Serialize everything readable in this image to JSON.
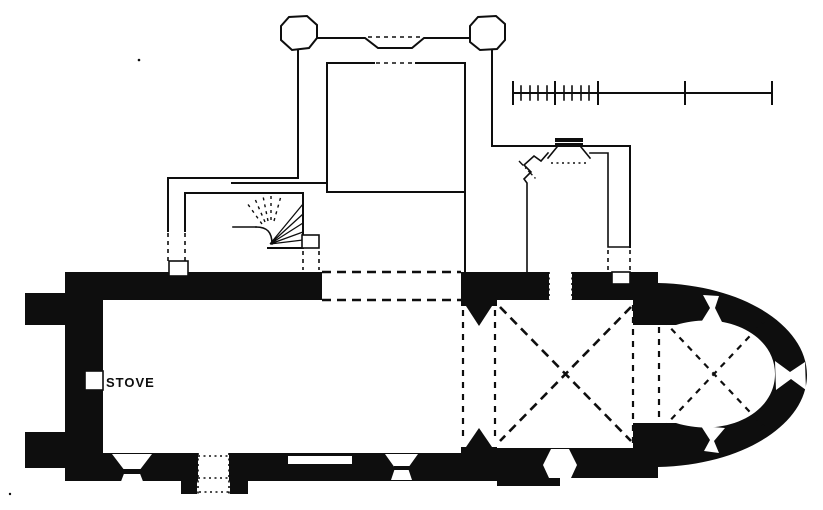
{
  "plan": {
    "labels": {
      "stove": "STOVE"
    },
    "colors": {
      "ink": "#0e0e0e",
      "paper": "#ffffff"
    }
  }
}
